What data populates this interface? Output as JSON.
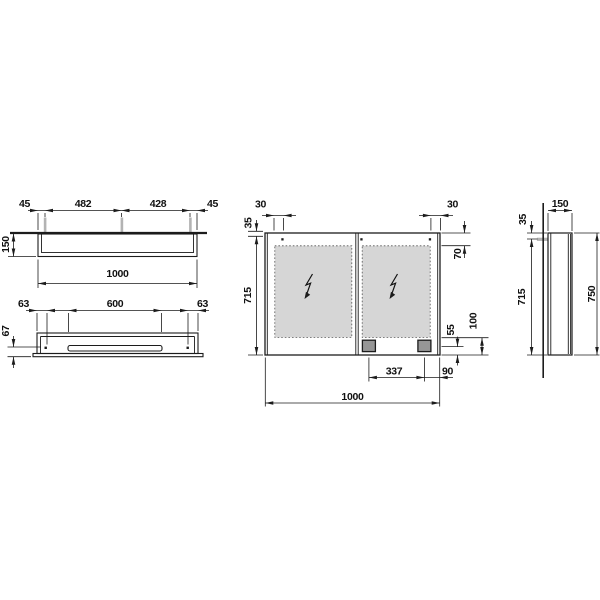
{
  "drawing": {
    "dims": {
      "top": {
        "edge_left": "45",
        "clip_span_left": "482",
        "clip_span_right": "428",
        "edge_right": "45",
        "depth": "150",
        "width": "1000"
      },
      "bottom": {
        "edge_left": "63",
        "slot_width": "600",
        "edge_right": "63",
        "front_offset": "67"
      },
      "front": {
        "hinge_left": "30",
        "hinge_right": "30",
        "top_offset": "35",
        "door_height": "715",
        "lamp_height": "70",
        "socket_height": "55",
        "bottom_zone": "100",
        "socket_span": "337",
        "socket_edge": "90",
        "width": "1000"
      },
      "side": {
        "depth": "150",
        "top_offset": "35",
        "door_height": "715",
        "total_height": "750"
      }
    },
    "colors": {
      "line": "#1c1c1c",
      "mirror_fill": "#d6d6d6",
      "clip_fill": "#b3b3b3",
      "socket_fill": "#969696",
      "background": "#ffffff"
    }
  }
}
